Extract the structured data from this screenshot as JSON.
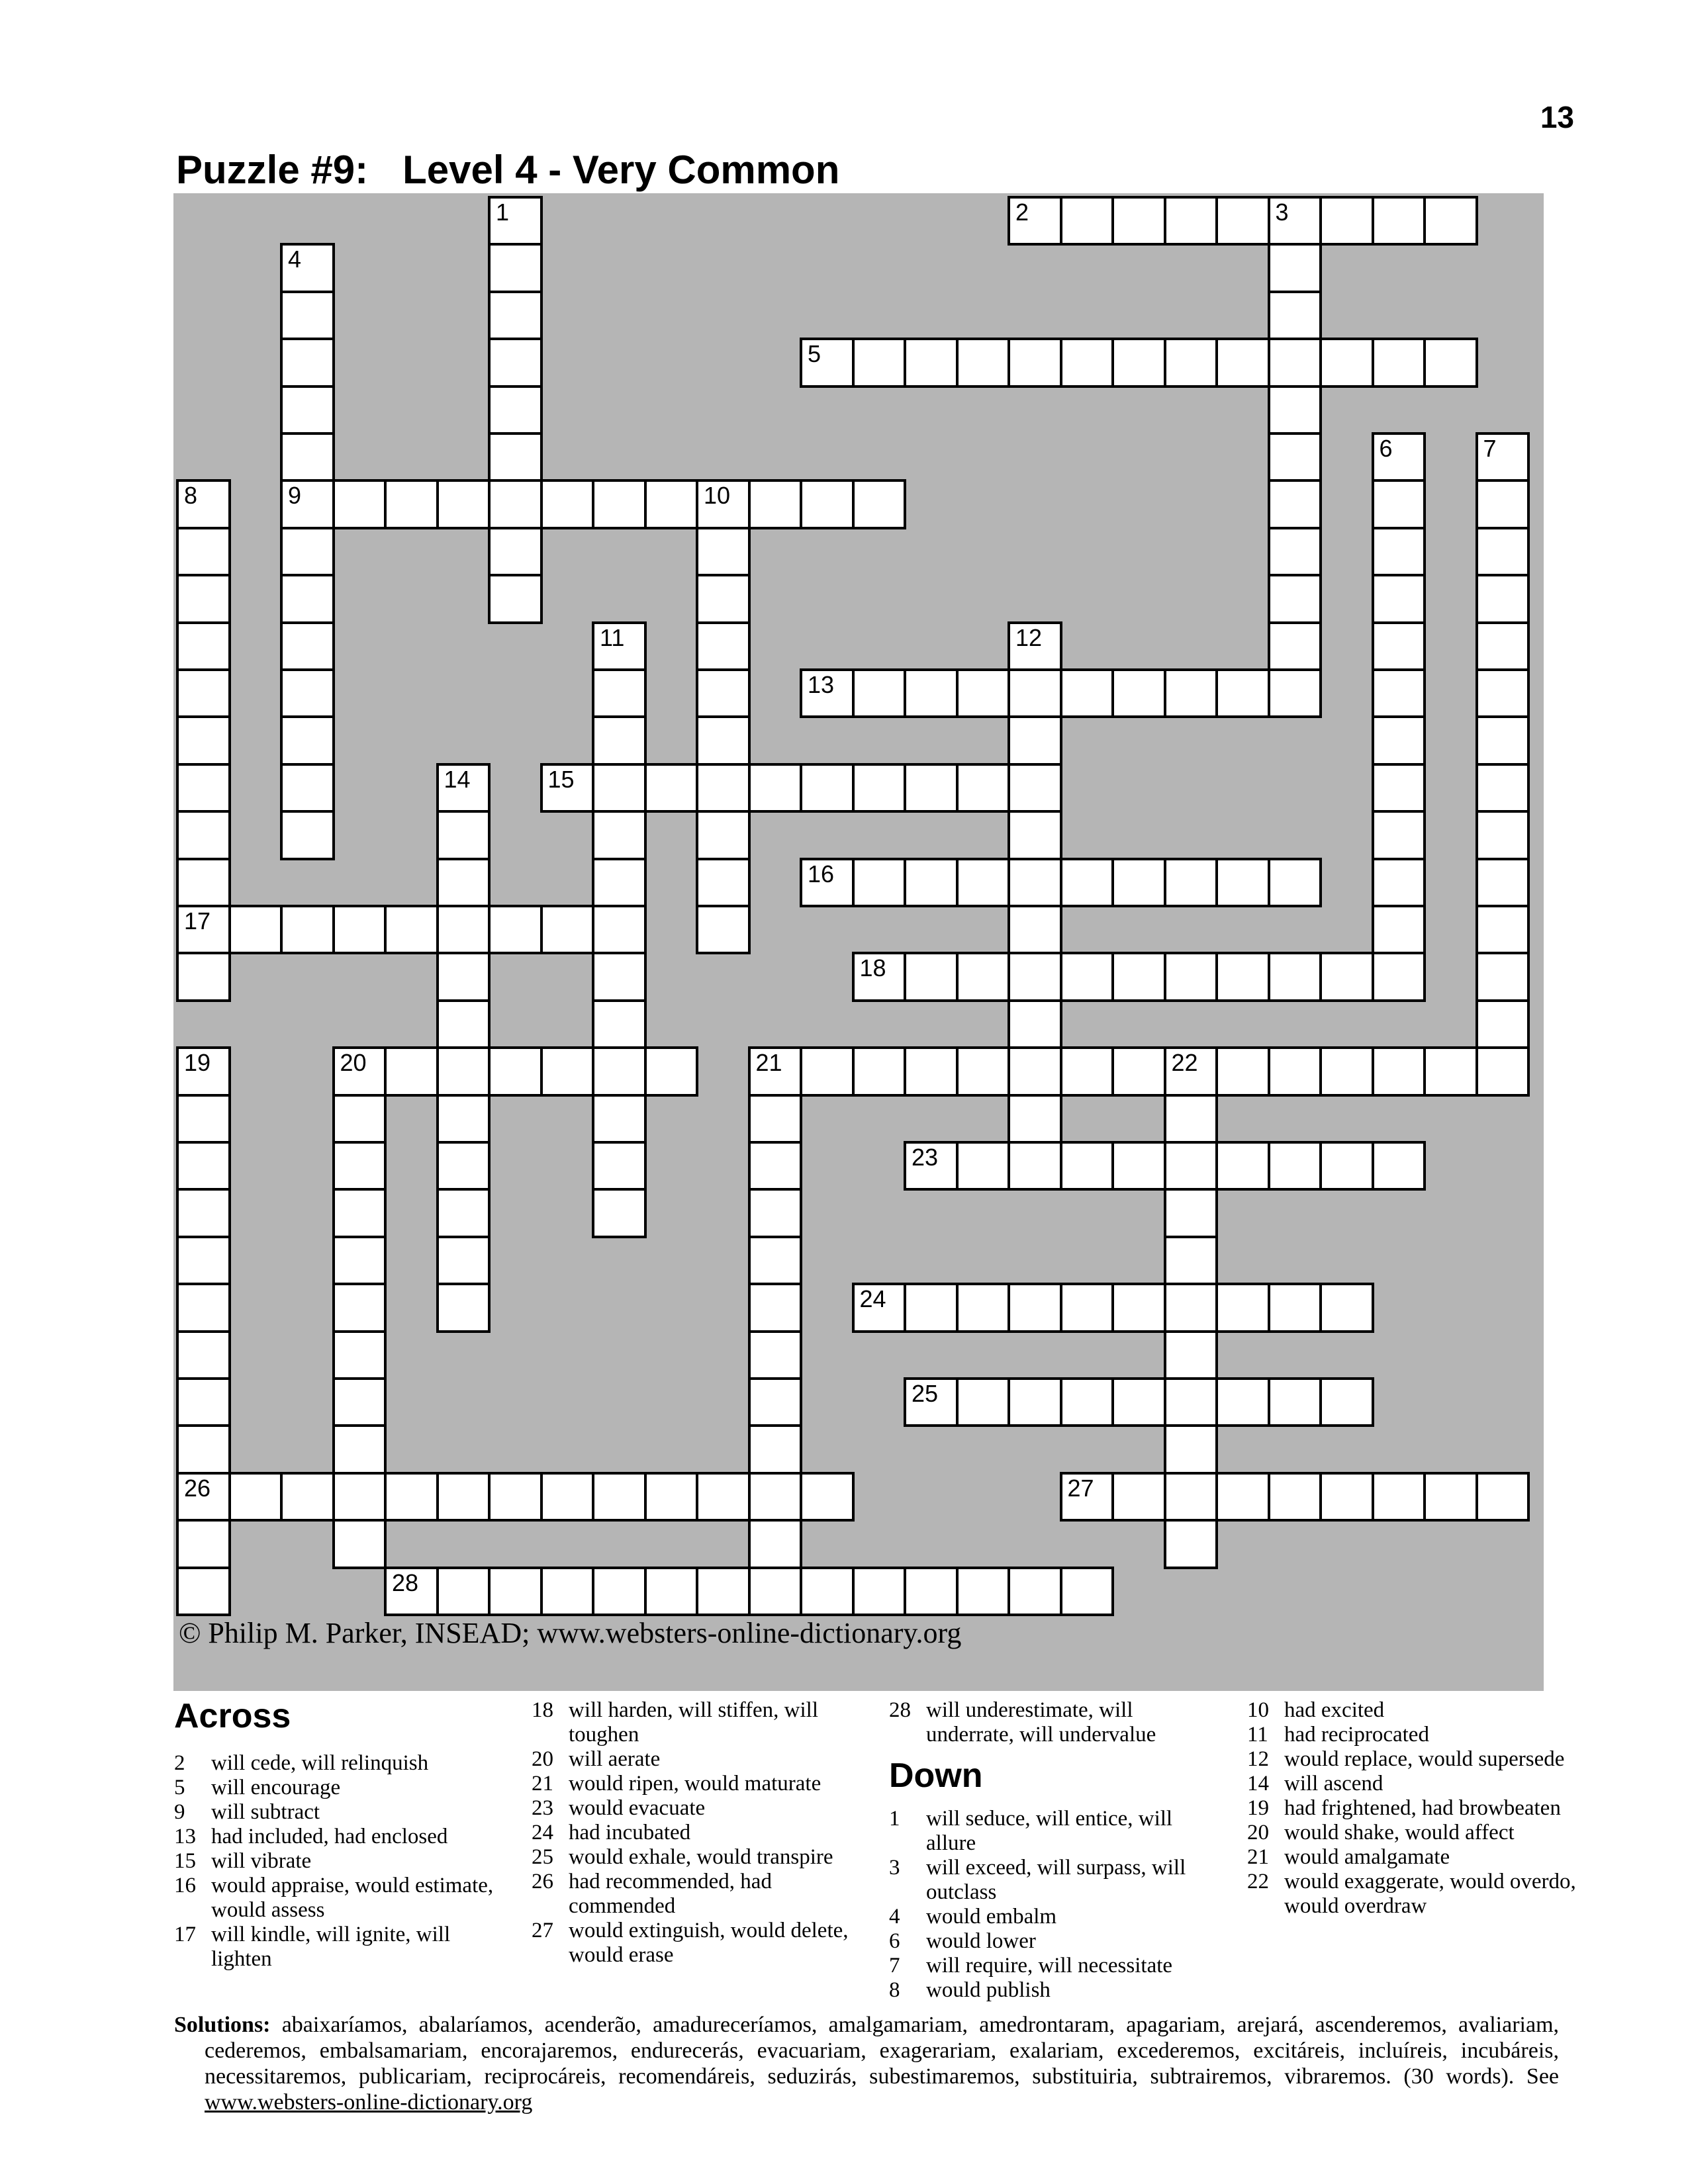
{
  "page": {
    "number": "13"
  },
  "title": {
    "prefix": "Puzzle #9:",
    "level": "Level 4 - Very Common"
  },
  "copyright": "© Philip M. Parker, INSEAD; www.websters-online-dictionary.org",
  "grid": {
    "cols": 26,
    "rows": 30,
    "colors": {
      "background": "#b5b5b5",
      "cell": "#ffffff",
      "line": "#000000"
    },
    "entries": [
      {
        "num": 1,
        "dir": "down",
        "row": 0,
        "col": 6,
        "len": 9
      },
      {
        "num": 2,
        "dir": "across",
        "row": 0,
        "col": 16,
        "len": 9
      },
      {
        "num": 3,
        "dir": "down",
        "row": 0,
        "col": 21,
        "len": 11
      },
      {
        "num": 4,
        "dir": "down",
        "row": 1,
        "col": 2,
        "len": 13
      },
      {
        "num": 5,
        "dir": "across",
        "row": 3,
        "col": 12,
        "len": 13
      },
      {
        "num": 6,
        "dir": "down",
        "row": 5,
        "col": 23,
        "len": 12
      },
      {
        "num": 7,
        "dir": "down",
        "row": 5,
        "col": 25,
        "len": 14
      },
      {
        "num": 8,
        "dir": "down",
        "row": 6,
        "col": 0,
        "len": 11
      },
      {
        "num": 9,
        "dir": "across",
        "row": 6,
        "col": 2,
        "len": 12
      },
      {
        "num": 10,
        "dir": "down",
        "row": 6,
        "col": 10,
        "len": 10
      },
      {
        "num": 11,
        "dir": "down",
        "row": 9,
        "col": 8,
        "len": 13
      },
      {
        "num": 12,
        "dir": "down",
        "row": 9,
        "col": 16,
        "len": 12
      },
      {
        "num": 13,
        "dir": "across",
        "row": 10,
        "col": 12,
        "len": 10
      },
      {
        "num": 14,
        "dir": "down",
        "row": 12,
        "col": 5,
        "len": 12
      },
      {
        "num": 15,
        "dir": "across",
        "row": 12,
        "col": 7,
        "len": 10
      },
      {
        "num": 16,
        "dir": "across",
        "row": 14,
        "col": 12,
        "len": 10
      },
      {
        "num": 17,
        "dir": "across",
        "row": 15,
        "col": 0,
        "len": 9
      },
      {
        "num": 18,
        "dir": "across",
        "row": 16,
        "col": 13,
        "len": 11
      },
      {
        "num": 19,
        "dir": "down",
        "row": 18,
        "col": 0,
        "len": 12
      },
      {
        "num": 20,
        "dir": "across",
        "row": 18,
        "col": 3,
        "len": 7
      },
      {
        "num": 20,
        "dir": "down",
        "row": 18,
        "col": 3,
        "len": 11
      },
      {
        "num": 21,
        "dir": "across",
        "row": 18,
        "col": 11,
        "len": 15
      },
      {
        "num": 21,
        "dir": "down",
        "row": 18,
        "col": 11,
        "len": 12
      },
      {
        "num": 22,
        "dir": "down",
        "row": 18,
        "col": 19,
        "len": 11
      },
      {
        "num": 23,
        "dir": "across",
        "row": 20,
        "col": 14,
        "len": 10
      },
      {
        "num": 24,
        "dir": "across",
        "row": 23,
        "col": 13,
        "len": 10
      },
      {
        "num": 25,
        "dir": "across",
        "row": 25,
        "col": 14,
        "len": 9
      },
      {
        "num": 26,
        "dir": "across",
        "row": 27,
        "col": 0,
        "len": 13
      },
      {
        "num": 27,
        "dir": "across",
        "row": 27,
        "col": 17,
        "len": 9
      },
      {
        "num": 28,
        "dir": "across",
        "row": 29,
        "col": 4,
        "len": 14
      }
    ]
  },
  "across": {
    "header": "Across",
    "clues": [
      {
        "num": 2,
        "text": "will cede, will relinquish"
      },
      {
        "num": 5,
        "text": "will encourage"
      },
      {
        "num": 9,
        "text": "will subtract"
      },
      {
        "num": 13,
        "text": "had included, had enclosed"
      },
      {
        "num": 15,
        "text": "will vibrate"
      },
      {
        "num": 16,
        "text": "would appraise, would estimate,\nwould assess"
      },
      {
        "num": 17,
        "text": "will kindle, will ignite, will\nlighten"
      },
      {
        "num": 18,
        "text": "will harden, will stiffen, will\ntoughen"
      },
      {
        "num": 20,
        "text": "will aerate"
      },
      {
        "num": 21,
        "text": "would ripen, would maturate"
      },
      {
        "num": 23,
        "text": "would evacuate"
      },
      {
        "num": 24,
        "text": "had incubated"
      },
      {
        "num": 25,
        "text": "would exhale, would transpire"
      },
      {
        "num": 26,
        "text": "had recommended, had\ncommended"
      },
      {
        "num": 27,
        "text": "would extinguish, would delete,\nwould erase"
      },
      {
        "num": 28,
        "text": "will underestimate, will\nunderrate, will undervalue"
      }
    ]
  },
  "down": {
    "header": "Down",
    "clues": [
      {
        "num": 1,
        "text": "will seduce, will entice, will allure"
      },
      {
        "num": 3,
        "text": "will exceed, will surpass, will\noutclass"
      },
      {
        "num": 4,
        "text": "would embalm"
      },
      {
        "num": 6,
        "text": "would lower"
      },
      {
        "num": 7,
        "text": "will require, will necessitate"
      },
      {
        "num": 8,
        "text": "would publish"
      },
      {
        "num": 10,
        "text": "had excited"
      },
      {
        "num": 11,
        "text": "had reciprocated"
      },
      {
        "num": 12,
        "text": "would replace, would supersede"
      },
      {
        "num": 14,
        "text": "will ascend"
      },
      {
        "num": 19,
        "text": "had frightened, had browbeaten"
      },
      {
        "num": 20,
        "text": "would shake, would affect"
      },
      {
        "num": 21,
        "text": "would amalgamate"
      },
      {
        "num": 22,
        "text": "would exaggerate, would overdo,\nwould overdraw"
      }
    ]
  },
  "solutions": {
    "label": "Solutions:",
    "words": "abaixaríamos, abalaríamos, acenderão, amadureceríamos, amalgamariam, amedrontaram, apagariam, arejará, ascenderemos, avaliariam, cederemos, embalsamariam, encorajaremos, endurecerás, evacuariam, exagerariam, exalariam, excederemos, excitáreis, incluíreis, incubáreis, necessitaremos, publicariam, reciprocáreis, recomendáreis, seduzirás, subestimaremos, substituiria, subtrairemos, vibraremos.",
    "count_note": "(30 words).",
    "see_label": "See",
    "link": "www.websters-online-dictionary.org"
  }
}
